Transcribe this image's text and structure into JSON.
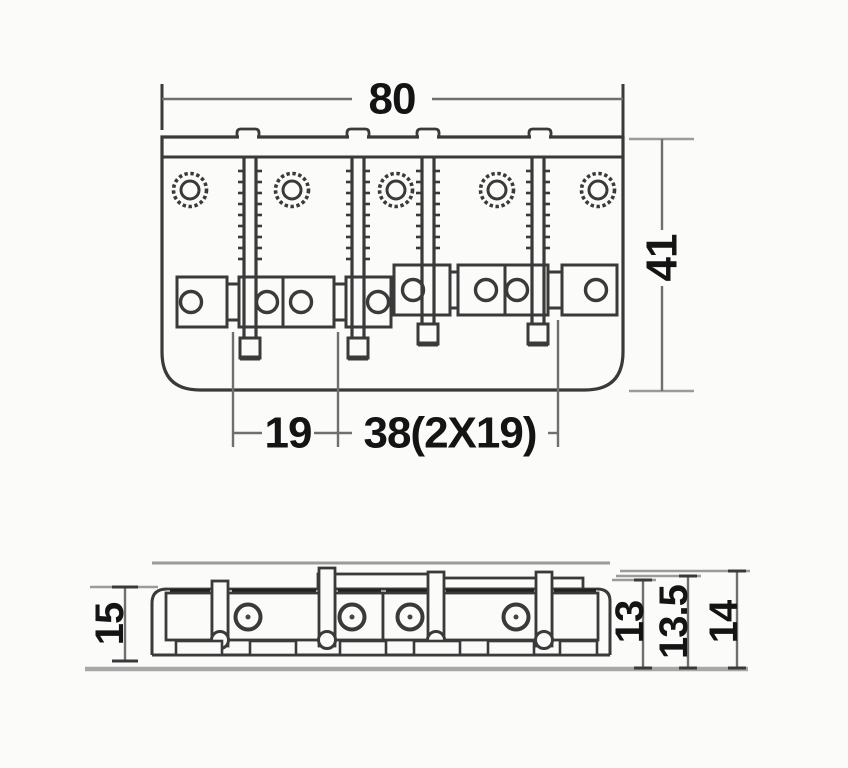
{
  "drawing": {
    "title": "bass-bridge-dimension-diagram",
    "top_view": {
      "width_label": "80",
      "height_label": "41",
      "string_spacing_label": "19",
      "total_spacing_label": "38(2X19)"
    },
    "side_view": {
      "left_height_label": "15",
      "height_labels": [
        "13",
        "13.5",
        "14"
      ]
    },
    "colors": {
      "ink": "#3a3a3a",
      "dim_line": "#6f6f6f",
      "gray": "#9b9b9b",
      "text": "#141414",
      "background": "#fbfbf9"
    }
  }
}
